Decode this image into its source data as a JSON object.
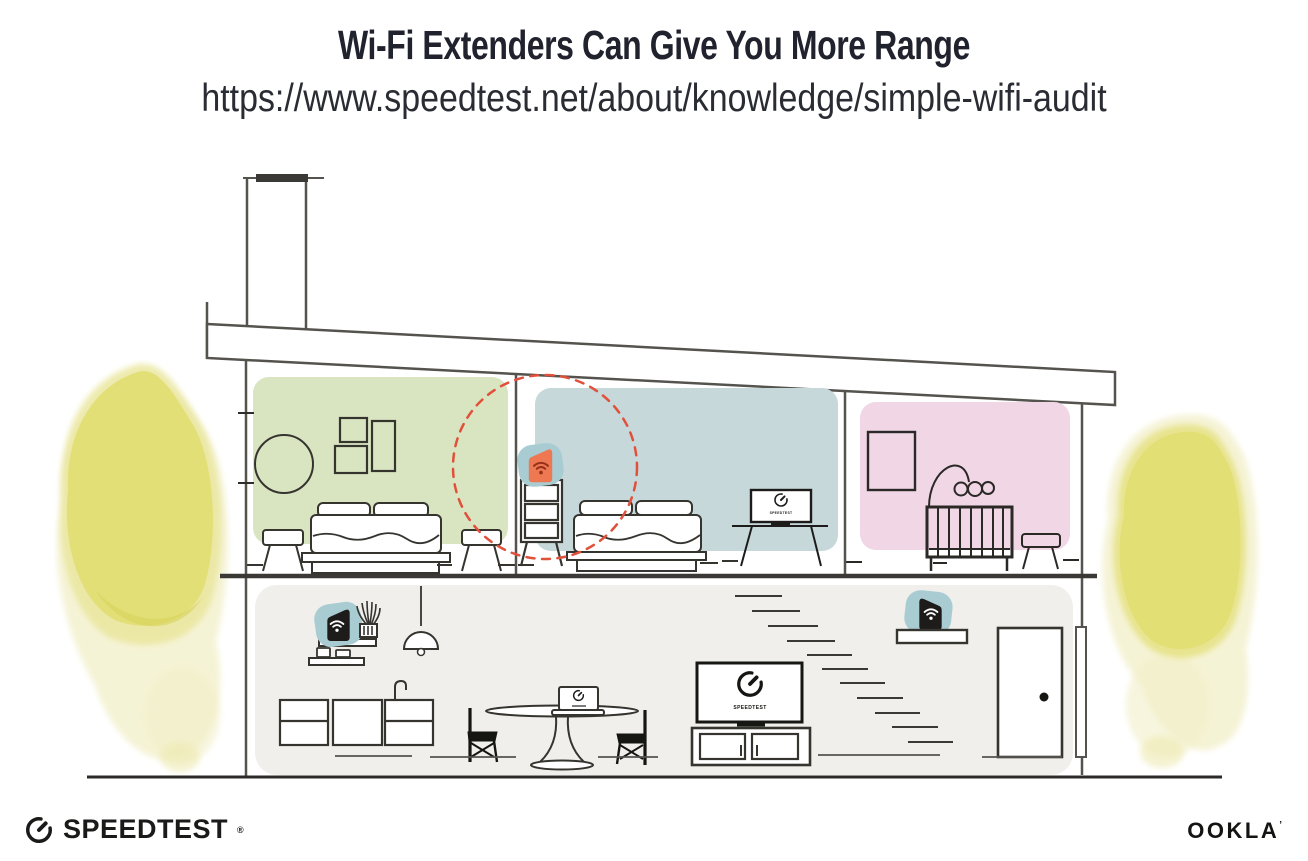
{
  "header": {
    "title": "Wi-Fi Extenders Can Give You More Range",
    "url": "https://www.speedtest.net/about/knowledge/simple-wifi-audit"
  },
  "scene": {
    "tv_label": "SPEEDTEST",
    "devices": [
      {
        "name": "wifi-extender-on-dresser",
        "style": "orange-highlighted-with-dashed-circle"
      },
      {
        "name": "wifi-router-kitchen-shelf",
        "style": "black"
      },
      {
        "name": "wifi-extender-stair-shelf",
        "style": "black"
      }
    ],
    "colors": {
      "bedroom_left": "#d9e5c1",
      "bedroom_middle": "#c6d8da",
      "nursery": "#f1d6e6",
      "downstairs": "#f0efec",
      "trees": "#e2df76",
      "extender_orange": "#ed7851",
      "device_halo": "#a9ccd3",
      "highlight_dashed": "#e0503a",
      "outline": "#55534e"
    }
  },
  "footer": {
    "speedtest": "SPEEDTEST",
    "speedtest_mark": "®",
    "ookla": "OOKLA",
    "ookla_mark": "’"
  }
}
